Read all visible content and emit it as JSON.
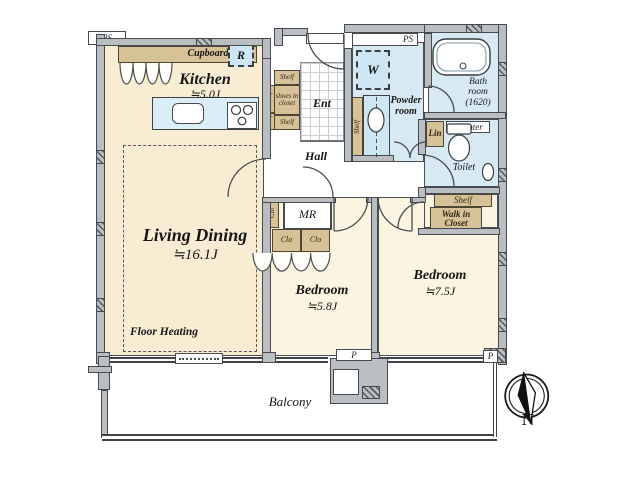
{
  "rooms": {
    "kitchen": {
      "label": "Kitchen",
      "area": "≒5.0J"
    },
    "living_dining": {
      "label": "Living Dining",
      "area": "≒16.1J"
    },
    "bedroom_small": {
      "label": "Bedroom",
      "area": "≒5.8J"
    },
    "bedroom_large": {
      "label": "Bedroom",
      "area": "≒7.5J"
    },
    "entrance": {
      "label": "Ent"
    },
    "hall": {
      "label": "Hall"
    },
    "powder_room": {
      "label": "Powder room"
    },
    "bath_room": {
      "label": "Bath room (1620)"
    },
    "toilet": {
      "label": "Toilet"
    },
    "walk_in_closet": {
      "label": "Walk in Closet"
    },
    "storage_room": {
      "label": "MR"
    },
    "balcony": {
      "label": "Balcony"
    }
  },
  "annotations": {
    "floor_heating": "Floor Heating",
    "shoes_in_closet": "shoes in closet",
    "north": "N"
  },
  "fixtures": {
    "cupboard": "Cupboard",
    "refrigerator": "R",
    "washing_machine": "W",
    "linen_cabinet": "Lin",
    "counter": "Counter",
    "shelf": "Shelf",
    "closet": "Clo",
    "pipe_space": "PS",
    "pipe_shaft": "P"
  },
  "colors": {
    "floor_main": "#f8ecd2",
    "floor_bedroom": "#fbf4e0",
    "wet_area": "#d7eaf4",
    "cabinet": "#d7c298",
    "wall": "#b9bec3"
  }
}
